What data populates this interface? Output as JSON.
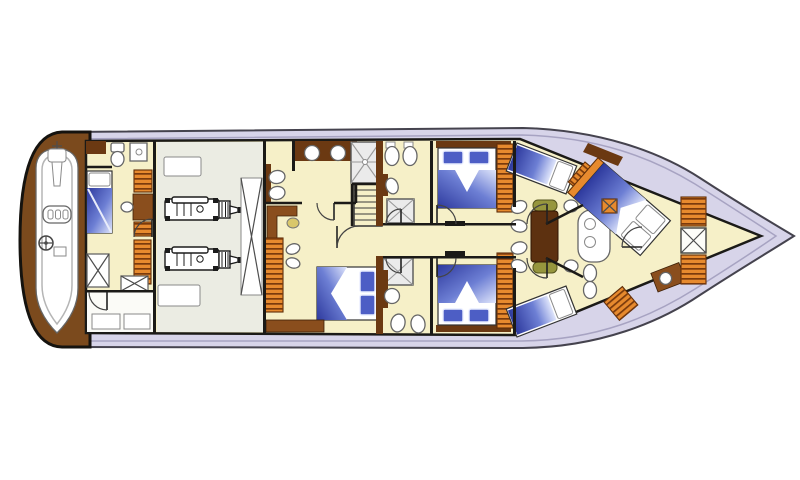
{
  "meta": {
    "type": "yacht-lower-deck-floor-plan",
    "orientation": "bow-right",
    "canvas": {
      "width": 800,
      "height": 480
    },
    "background": "#ffffff",
    "visible_text": "none"
  },
  "palette": {
    "hull_fill": "#d7d4e9",
    "hull_outline": "#45434e",
    "hull_inner_line": "#a7a3c2",
    "interior_floor": "#f6f0c8",
    "engine_room_floor": "#ebece3",
    "utility_floor": "#fbfbf7",
    "wall_dark": "#1b1a17",
    "wood_dark": "#6b3912",
    "wood_mid": "#8a4e1d",
    "platform_wood": "#7b4a1d",
    "locker_orange": "#e78a2e",
    "locker_stripe": "#7a3a0c",
    "bed_blue_dark": "#2e3a9e",
    "bed_blue_mid": "#6d7fd4",
    "bed_blue_light": "#dfe5fb",
    "pillow_blue": "#4d5ec5",
    "fixture_fill": "#ffffff",
    "fixture_stroke": "#666666",
    "shower_fill": "#ebebeb",
    "shower_line": "#9a9a9a",
    "bench_olive": "#96963d",
    "table_wood": "#5d3110",
    "chair_yellow": "#d9c76b",
    "door_arc": "#444444"
  },
  "components": [
    {
      "id": "hull",
      "label": "yacht hull outline, bow pointing right"
    },
    {
      "id": "swim-platform",
      "label": "teak swim platform at stern"
    },
    {
      "id": "tender",
      "label": "tender dinghy with outboard motor, seat and steering wheel"
    },
    {
      "id": "crew-cabin",
      "label": "crew cabin with single berth and head"
    },
    {
      "id": "lazarette",
      "label": "stern storage room"
    },
    {
      "id": "engine-room",
      "label": "engine room with twin engines and tank"
    },
    {
      "id": "master-cabin",
      "label": "master cabin with double bed, vanity and en-suite"
    },
    {
      "id": "staircase",
      "label": "companionway stairs to main deck"
    },
    {
      "id": "corridor",
      "label": "central corridor"
    },
    {
      "id": "guest-cabin-top",
      "label": "port guest cabin with double bed"
    },
    {
      "id": "guest-cabin-bottom",
      "label": "starboard guest cabin with double bed"
    },
    {
      "id": "guest-bathroom-top",
      "label": "port guest head with shower"
    },
    {
      "id": "guest-bathroom-bottom",
      "label": "starboard guest head with shower"
    },
    {
      "id": "dinette",
      "label": "dinette with table, benches and chairs"
    },
    {
      "id": "galley-counter",
      "label": "counter unit with twin round sinks"
    },
    {
      "id": "forward-cabin-port",
      "label": "forward port cabin with angled berth"
    },
    {
      "id": "forward-cabin-starboard",
      "label": "forward starboard cabin with angled berth"
    },
    {
      "id": "vip-cabin",
      "label": "VIP bow cabin with diagonal double bed"
    },
    {
      "id": "bow-lockers",
      "label": "bow locker stack with cross-front cabinet"
    }
  ]
}
